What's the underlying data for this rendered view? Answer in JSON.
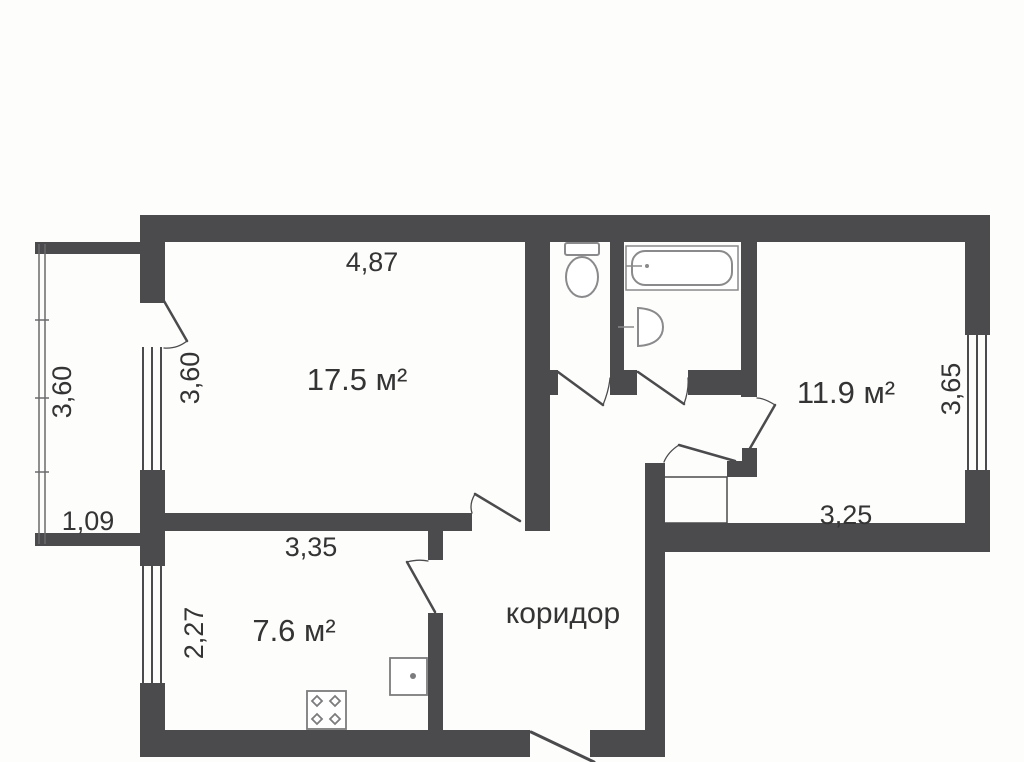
{
  "colors": {
    "wall": "#4b4b4d",
    "railing": "#6b6b6d",
    "fixture": "#8a8a8c",
    "kitchen_fixture": "#7c7c7e",
    "text": "#343434",
    "background": "#fdfdfc"
  },
  "rooms": {
    "living": {
      "area": "17.5 м²"
    },
    "kitchen": {
      "area": "7.6 м²"
    },
    "bedroom": {
      "area": "11.9 м²"
    },
    "corridor": {
      "name": "коридор"
    }
  },
  "dimensions": {
    "living_width_top": "4,87",
    "living_height_left": "3,60",
    "balcony_height_left": "3,60",
    "balcony_width_bottom": "1,09",
    "kitchen_width_top": "3,35",
    "kitchen_height_left": "2,27",
    "bedroom_height_right": "3,65",
    "bedroom_width_bottom": "3,25"
  },
  "fixtures": {
    "toilet": "toilet-icon",
    "bathtub": "bathtub-icon",
    "washbasin": "washbasin-icon",
    "stove": "stove-4-burner-icon",
    "kitchen_sink": "kitchen-sink-icon"
  }
}
